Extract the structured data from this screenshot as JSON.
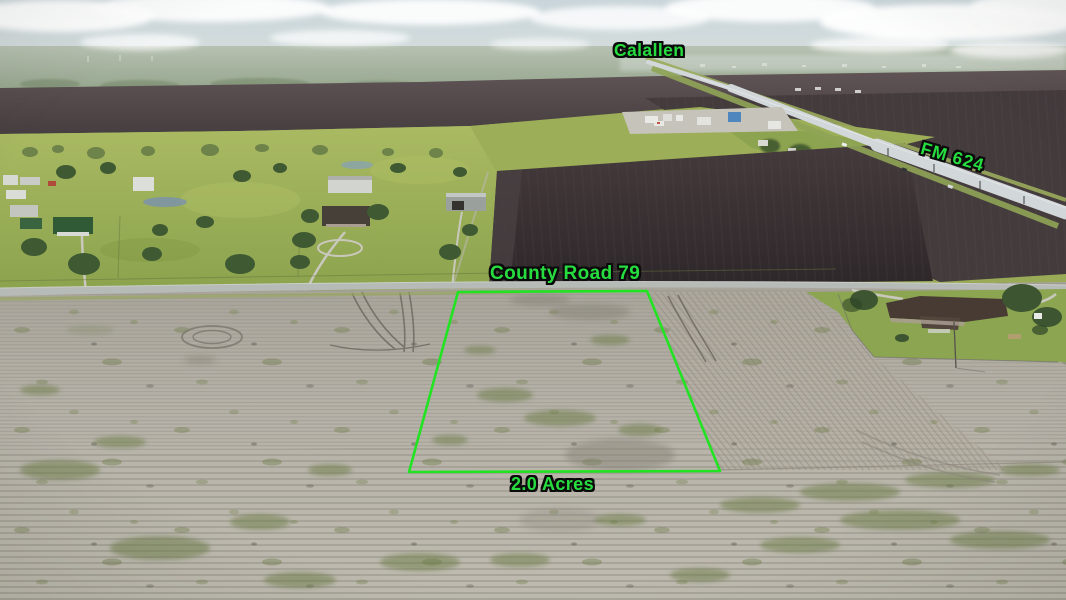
{
  "photo": {
    "annotations": {
      "town_label": "Calallen",
      "highway_label": "FM 624",
      "county_road_label": "County Road 79",
      "acreage_label": "2.0 Acres"
    },
    "colors": {
      "annotation_text_green": "#26DC3F",
      "annotation_outline_black": "#0B0B0B",
      "parcel_boundary_green": "#22E322"
    }
  }
}
